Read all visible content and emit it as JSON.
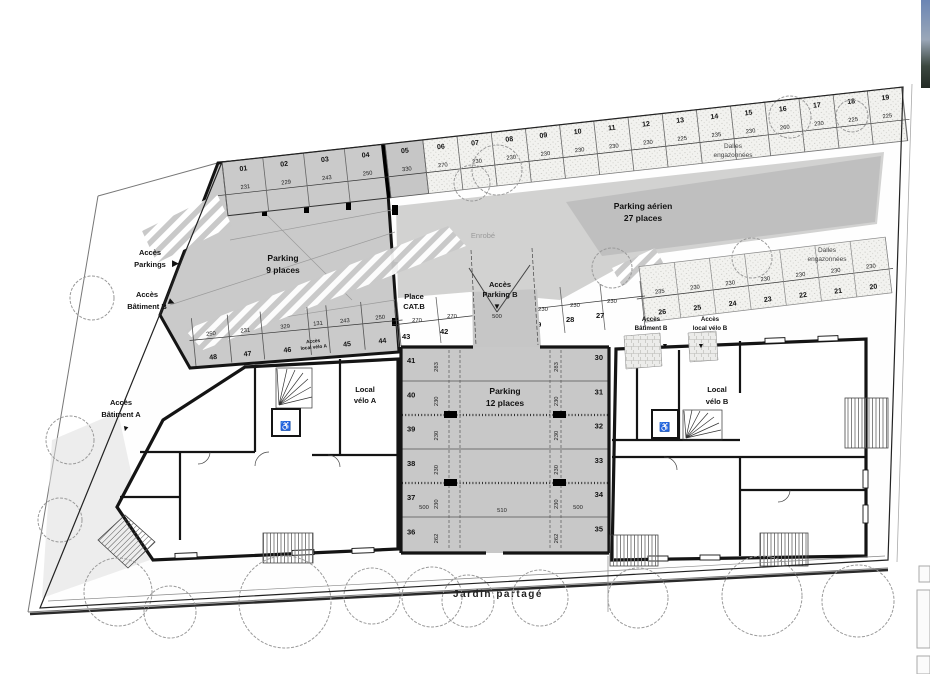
{
  "colors": {
    "background": "#ffffff",
    "line": "#1a1a1a",
    "parking_grey": "#cacaca",
    "driveway_grey": "#c6c6c6",
    "dark_band_grey": "#bfbfbf",
    "stipple_bg": "#f2f2ef"
  },
  "icons": {
    "arrow_right": "▶",
    "arrow_down": "▼",
    "wheelchair": "♿"
  },
  "street_labels": {
    "acces_parkings": [
      "Accès",
      "Parkings"
    ],
    "acces_batiment_b": [
      "Accès",
      "Bâtiment B"
    ],
    "acces_batiment_a": [
      "Accès",
      "Bâtiment A"
    ]
  },
  "areas": {
    "parking9": [
      "Parking",
      "9 places"
    ],
    "parking_aerien": [
      "Parking aérien",
      "27 places"
    ],
    "parking12": [
      "Parking",
      "12 places"
    ],
    "enrobe": "Enrobé",
    "dalles": [
      "Dalles",
      "engazonnées"
    ],
    "place_cat": [
      "Place",
      "CAT.B"
    ],
    "acces_parking_b": [
      "Accès",
      "Parking B"
    ],
    "acces_local_velo_a": [
      "Accès",
      "local vélo A"
    ],
    "acces_batiment_b": [
      "Accès",
      "Bâtiment B"
    ],
    "acces_local_velo_b": [
      "Accès",
      "local vélo B"
    ],
    "local_velo_a": [
      "Local",
      "vélo A"
    ],
    "local_velo_b": [
      "Local",
      "vélo B"
    ],
    "jardin": "Jardin partagé"
  },
  "dims": {
    "ramp": "500",
    "garage_left": "500",
    "garage_aisle": "510",
    "garage_right": "500"
  },
  "top_spaces": [
    {
      "num": "01",
      "dim": "231"
    },
    {
      "num": "02",
      "dim": "229"
    },
    {
      "num": "03",
      "dim": "243"
    },
    {
      "num": "04",
      "dim": "250"
    },
    {
      "num": "05",
      "dim": "330"
    },
    {
      "num": "06",
      "dim": "270"
    },
    {
      "num": "07",
      "dim": "230"
    },
    {
      "num": "08",
      "dim": "230"
    },
    {
      "num": "09",
      "dim": "230"
    },
    {
      "num": "10",
      "dim": "230"
    },
    {
      "num": "11",
      "dim": "230"
    },
    {
      "num": "12",
      "dim": "230"
    },
    {
      "num": "13",
      "dim": "225"
    },
    {
      "num": "14",
      "dim": "235"
    },
    {
      "num": "15",
      "dim": "230"
    },
    {
      "num": "16",
      "dim": "260"
    },
    {
      "num": "17",
      "dim": "230"
    },
    {
      "num": "18",
      "dim": "225"
    },
    {
      "num": "19",
      "dim": "225"
    }
  ],
  "mid_spaces": [
    {
      "num": "26",
      "dim": "235"
    },
    {
      "num": "25",
      "dim": "230"
    },
    {
      "num": "24",
      "dim": "230"
    },
    {
      "num": "23",
      "dim": "230"
    },
    {
      "num": "22",
      "dim": "230"
    },
    {
      "num": "21",
      "dim": "230"
    },
    {
      "num": "20",
      "dim": "230"
    }
  ],
  "inner_spaces": [
    {
      "num": "43",
      "dim": "270"
    },
    {
      "num": "42",
      "dim": "270"
    },
    {
      "num": "29",
      "dim": "230"
    },
    {
      "num": "28",
      "dim": "230"
    },
    {
      "num": "27",
      "dim": "230"
    }
  ],
  "row44_spaces": [
    {
      "num": "48",
      "dim": "250"
    },
    {
      "num": "47",
      "dim": "231"
    },
    {
      "num": "46",
      "dim": "329"
    },
    {
      "num": "",
      "dim": "131"
    },
    {
      "num": "45",
      "dim": "243"
    },
    {
      "num": "44",
      "dim": "250"
    }
  ],
  "garage_left": [
    {
      "num": "41",
      "dim": "283"
    },
    {
      "num": "40",
      "dim": "230"
    },
    {
      "num": "39",
      "dim": "230"
    },
    {
      "num": "38",
      "dim": "230"
    },
    {
      "num": "37",
      "dim": "230"
    },
    {
      "num": "36",
      "dim": "262"
    }
  ],
  "garage_right": [
    {
      "num": "30",
      "dim": "283"
    },
    {
      "num": "31",
      "dim": "230"
    },
    {
      "num": "32",
      "dim": "230"
    },
    {
      "num": "33",
      "dim": "230"
    },
    {
      "num": "34",
      "dim": "230"
    },
    {
      "num": "35",
      "dim": "262"
    }
  ]
}
